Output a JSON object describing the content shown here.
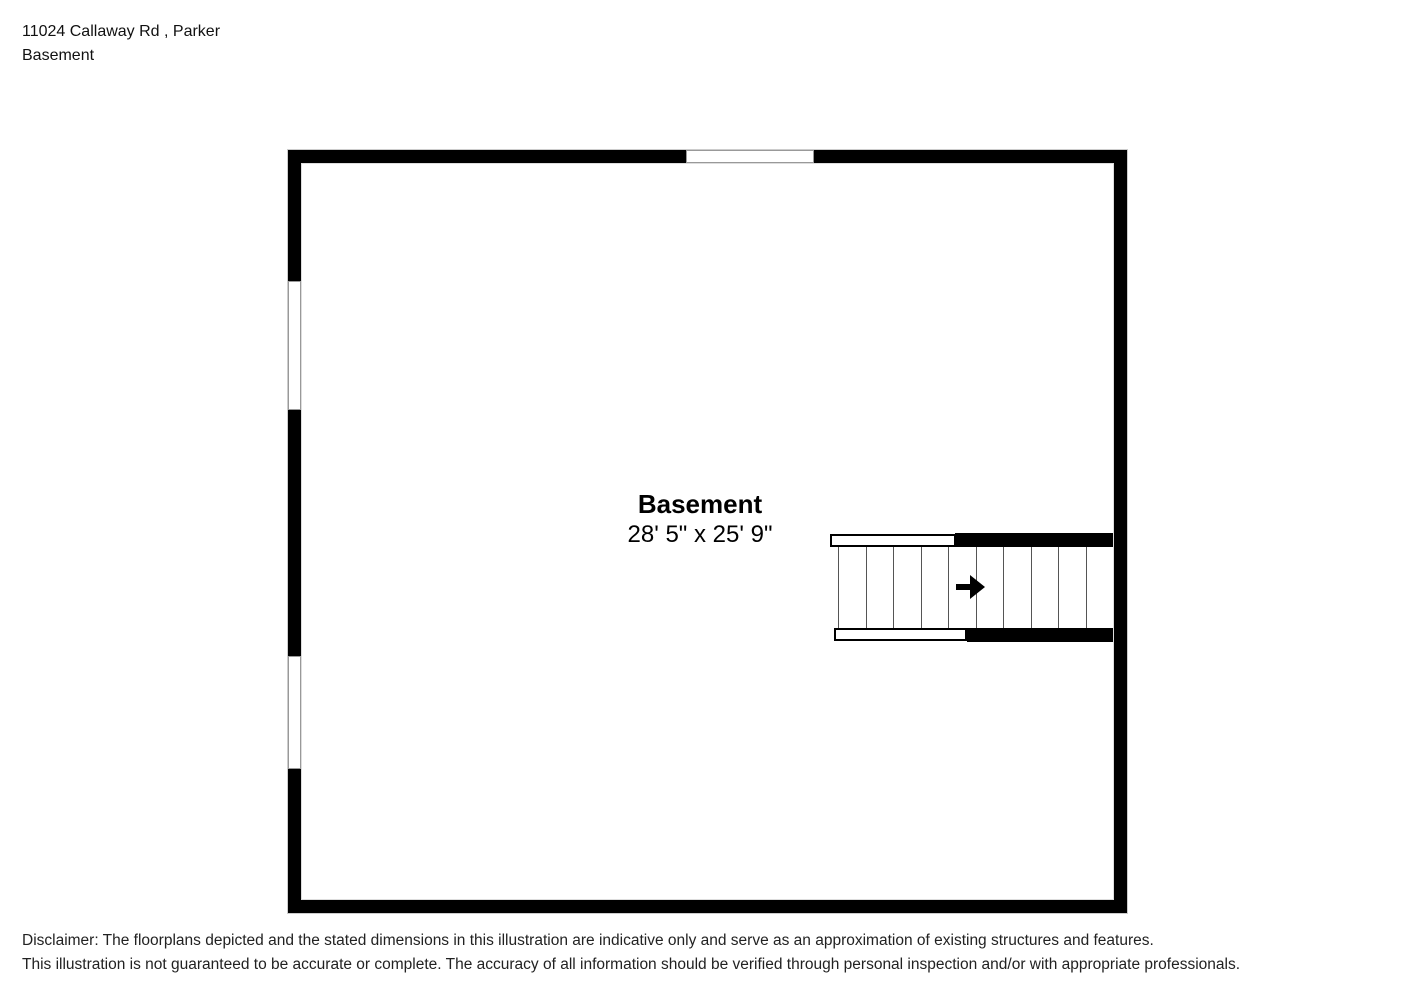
{
  "header": {
    "address": "11024 Callaway Rd , Parker",
    "subtitle": "Basement"
  },
  "room": {
    "name": "Basement",
    "dimensions": "28' 5\" x 25' 9\""
  },
  "floorplan": {
    "windows": [
      {
        "wall": "top",
        "position": "center"
      },
      {
        "wall": "left",
        "position": "upper"
      },
      {
        "wall": "left",
        "position": "lower"
      }
    ],
    "staircase": {
      "steps": 10,
      "direction_arrow": "right",
      "location": "middle-right"
    }
  },
  "disclaimer": {
    "line1": "Disclaimer: The floorplans depicted and the stated dimensions in this illustration are indicative only and serve as an approximation of existing structures and features.",
    "line2": "This illustration is not guaranteed to be accurate or complete. The accuracy of all information should be verified through personal inspection and/or with appropriate professionals."
  },
  "colors": {
    "wall": "#000000",
    "background": "#ffffff",
    "wall_outline": "#cccccc",
    "stair_line": "#555555",
    "window_border": "#999999",
    "text": "#111111"
  }
}
